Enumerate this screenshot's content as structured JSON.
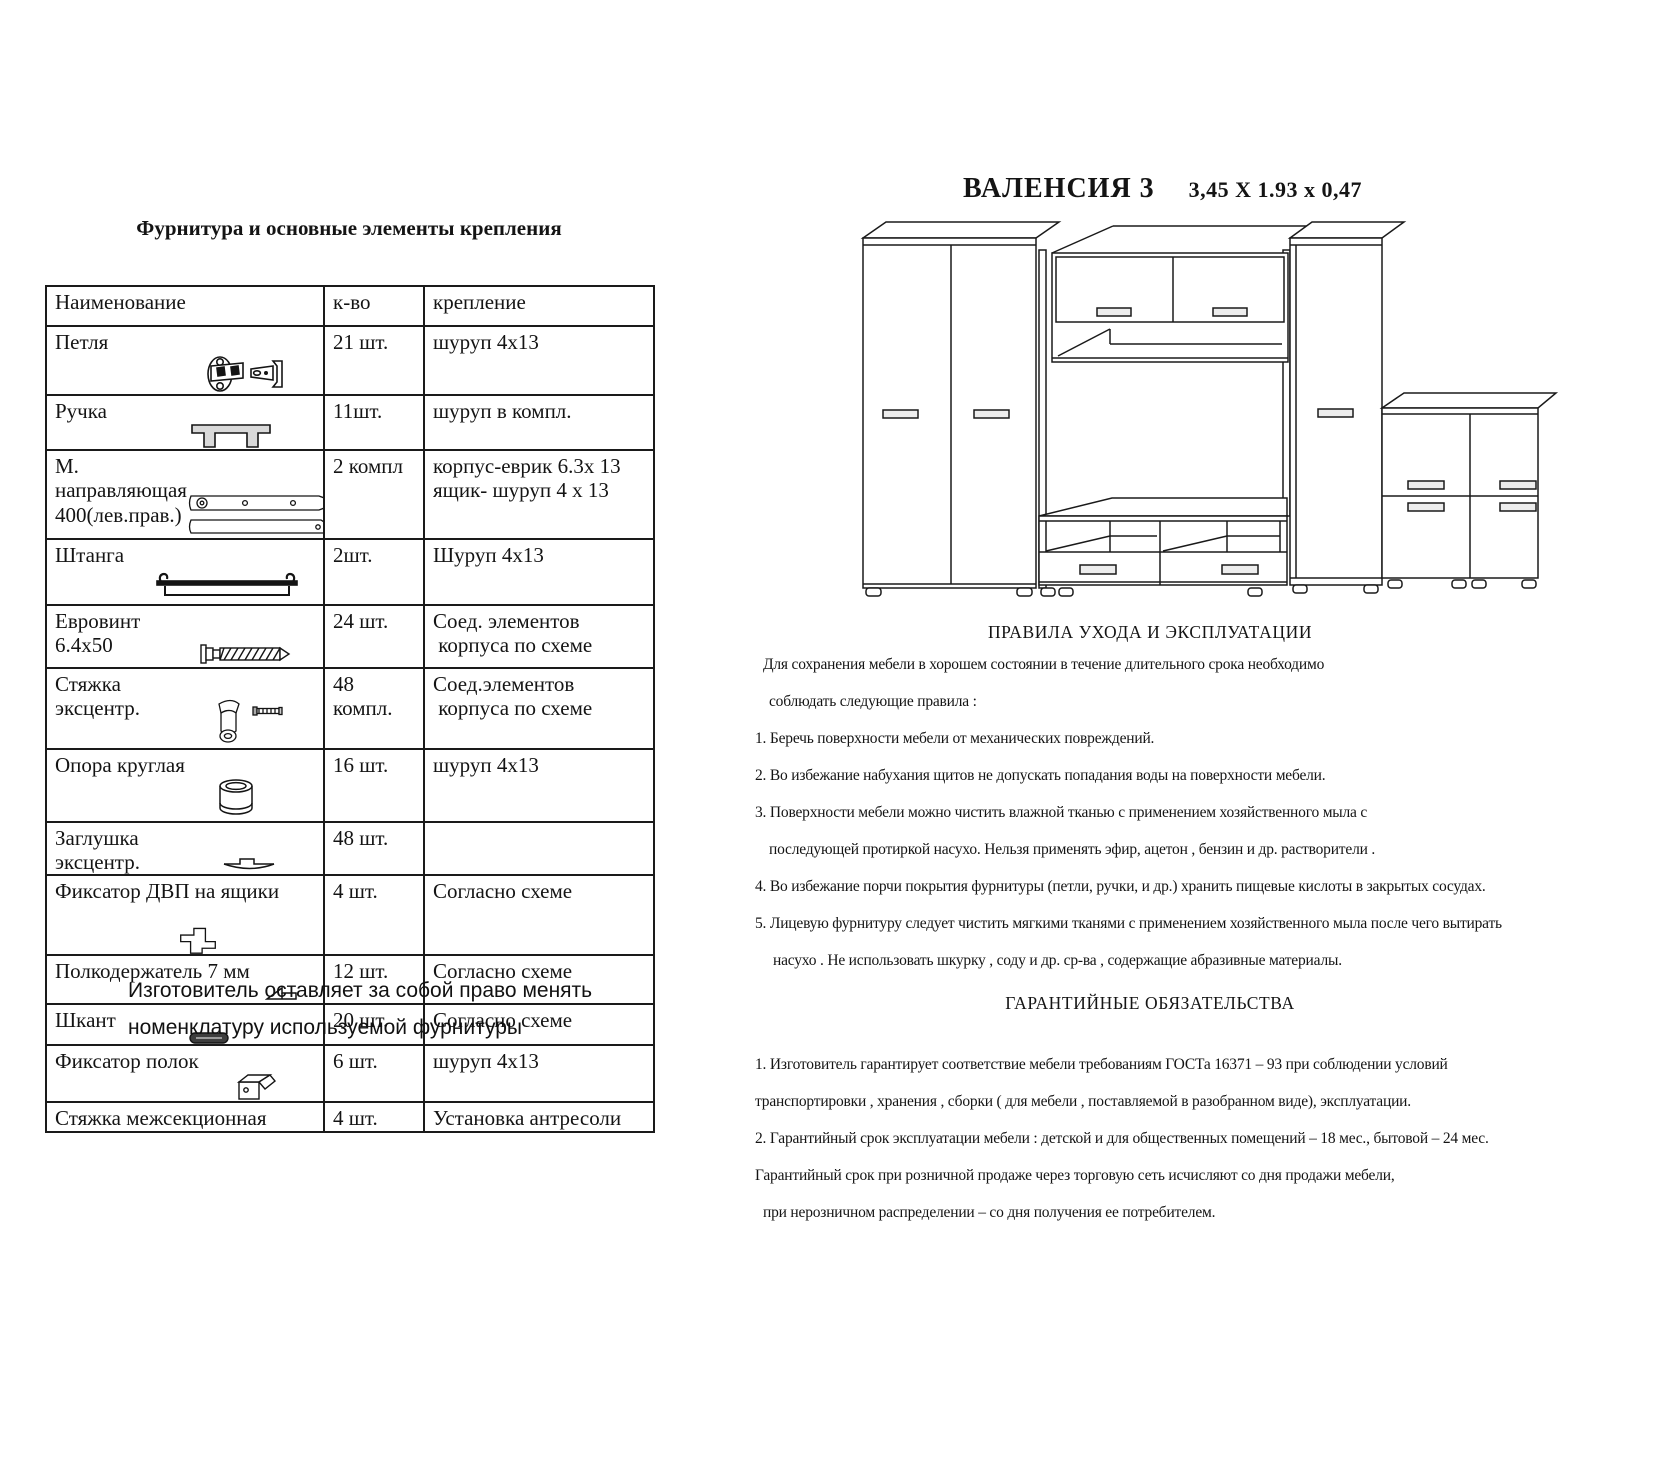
{
  "page": {
    "background": "#ffffff",
    "ink": "#1a1a1a"
  },
  "left": {
    "title": "Фурнитура и основные элементы крепления",
    "table": {
      "headers": {
        "name": "Наименование",
        "qty": "к-во",
        "fix": "крепление"
      },
      "rows": [
        {
          "name": "Петля",
          "icon": "hinge-icon",
          "qty": "21 шт.",
          "fix": "шуруп 4х13"
        },
        {
          "name": "Ручка",
          "icon": "handle-icon",
          "qty": "11шт.",
          "fix": "шуруп в компл."
        },
        {
          "name": "М. направляющая\n400(лев.прав.)",
          "icon": "drawer-slide-icon",
          "qty": "2 компл",
          "fix": "корпус-еврик 6.3х 13\nящик- шуруп 4 х 13"
        },
        {
          "name": "Штанга",
          "icon": "rod-icon",
          "qty": "2шт.",
          "fix": "Шуруп 4х13"
        },
        {
          "name": "Евровинт 6.4х50",
          "icon": "euro-screw-icon",
          "qty": "24 шт.",
          "fix": "Соед. элементов\n корпуса по схеме"
        },
        {
          "name": "Стяжка эксцентр.",
          "icon": "cam-lock-icon",
          "qty": "48\nкомпл.",
          "fix": "Соед.элементов\n корпуса по схеме"
        },
        {
          "name": "Опора круглая",
          "icon": "round-support-icon",
          "qty": "16 шт.",
          "fix": "шуруп 4х13"
        },
        {
          "name": "Заглушка эксцентр.",
          "icon": "cam-cap-icon",
          "qty": "48 шт.",
          "fix": ""
        },
        {
          "name": "Фиксатор ДВП на ящики",
          "icon": "hdf-clip-icon",
          "qty": "4 шт.",
          "fix": "Согласно схеме"
        },
        {
          "name": "Полкодержатель  7 мм",
          "icon": "shelf-pin-icon",
          "qty": "12 шт.",
          "fix": "Согласно схеме"
        },
        {
          "name": "Шкант",
          "icon": "dowel-icon",
          "qty": "20  шт.",
          "fix": "Согласно схеме"
        },
        {
          "name": "Фиксатор полок",
          "icon": "shelf-lock-icon",
          "qty": "6 шт.",
          "fix": "шуруп 4х13"
        },
        {
          "name": "Стяжка межсекционная",
          "icon": "none",
          "qty": "4 шт.",
          "fix": "Установка антресоли"
        }
      ]
    },
    "footnote": "Изготовитель оставляет за собой право менять\nноменклатуру используемой фурнитуры"
  },
  "right": {
    "product_name": "ВАЛЕНСИЯ  3",
    "dimensions": "3,45 X 1.93 x 0,47",
    "care": {
      "title": "ПРАВИЛА УХОДА И ЭКСПЛУАТАЦИИ",
      "lines": [
        "Для сохранения мебели в хорошем состоянии в течение длительного срока необходимо",
        "соблюдать следующие правила :",
        "1. Беречь поверхности мебели от механических повреждений.",
        "2. Во избежание набухания щитов не допускать попадания воды на поверхности мебели.",
        "3. Поверхности мебели можно чистить влажной тканью с применением хозяйственного мыла с",
        "последующей протиркой насухо. Нельзя применять эфир, ацетон , бензин и др. растворители .",
        "4. Во избежание порчи покрытия фурнитуры (петли, ручки, и др.) хранить пищевые кислоты в закрытых сосудах.",
        "5. Лицевую фурнитуру  следует чистить мягкими тканями с применением хозяйственного мыла после чего вытирать",
        "насухо . Не использовать шкурку , соду и др. ср-ва , содержащие абразивные материалы."
      ]
    },
    "warranty": {
      "title": "ГАРАНТИЙНЫЕ ОБЯЗАТЕЛЬСТВА",
      "lines": [
        "1. Изготовитель гарантирует соответствие мебели требованиям ГОСТа 16371 – 93 при соблюдении условий",
        "транспортировки , хранения , сборки ( для мебели , поставляемой в разобранном виде), эксплуатации.",
        "2. Гарантийный срок эксплуатации мебели : детской и для общественных помещений – 18 мес., бытовой – 24 мес.",
        "Гарантийный срок при розничной продаже через торговую  сеть исчисляют со дня  продажи мебели,",
        "при  нерозничном распределении – со дня получения ее потребителем."
      ]
    }
  }
}
